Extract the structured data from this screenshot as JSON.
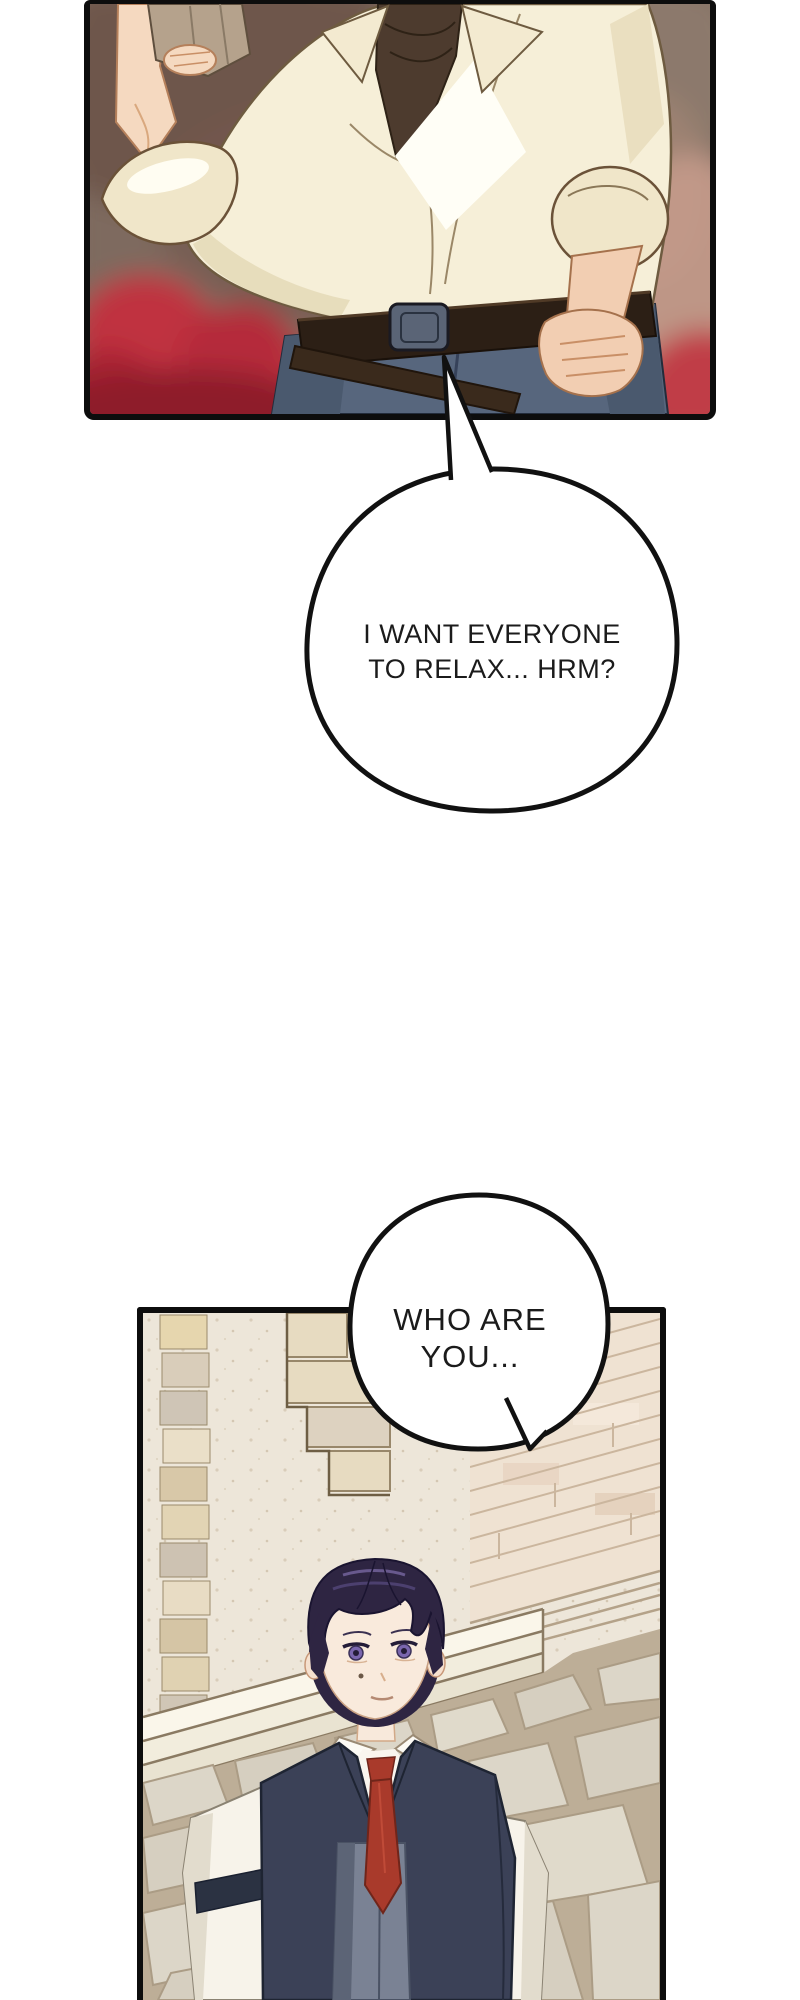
{
  "page": {
    "kind": "webtoon comic strip segment",
    "background_color": "#ffffff"
  },
  "speech_bubbles": [
    {
      "id": "bubble-1",
      "lines": [
        "I WANT EVERYONE",
        "TO RELAX... HRM?"
      ],
      "tail_direction": "up into panel 1",
      "fill": "#ffffff",
      "outline": "#111111",
      "text_color": "#1b1b1b"
    },
    {
      "id": "bubble-2",
      "lines": [
        "WHO ARE",
        "YOU..."
      ],
      "tail_direction": "down-right over panel 2",
      "fill": "#ffffff",
      "outline": "#111111",
      "text_color": "#1b1b1b"
    }
  ],
  "panels": [
    {
      "id": "panel-1",
      "description": "Torso of a man in a loose cream shirt over a dark brown turtleneck; right hand raised holding a tan cloth, left hand on hip; dark belt with diagonal strap and slate-blue trousers; blurred red and brown hall background",
      "colors": {
        "border": "#0d0d0d",
        "background_brown": "#7E6A5F",
        "chair_red": "#C0313F",
        "shirt_cream": "#F6EFD8",
        "turtleneck_brown": "#4D3B2E",
        "belt_brown": "#2C1F15",
        "buckle_slate": "#5A6476",
        "pants_slate": "#57667D",
        "skin": "#F5D9C0",
        "cloth_tan": "#B5A28C"
      }
    },
    {
      "id": "panel-2",
      "description": "Young man with dark purple hair and violet eyes, wearing a white shirt, red tie and navy vest, standing in a cream stone courtyard with brick walls, a white plinth and flagstone pavement",
      "colors": {
        "border": "#0d0d0d",
        "plaster": "#EDE6D9",
        "brick_tan": "#E6D6AE",
        "brick_wall_pink": "#EFE2D2",
        "plinth_white": "#FAF6EA",
        "pavement_mortar": "#BDAE97",
        "flagstone": "#DCD6C8",
        "hair_purple": "#2E2542",
        "hair_highlight": "#6F5F96",
        "skin": "#F9EADC",
        "eye_violet": "#7A66AE",
        "shirt_white": "#F7F3EA",
        "vest_navy": "#3B4157",
        "vest_panel_gray": "#7A8294",
        "armband_navy": "#2B3242",
        "tie_red": "#A93A2B"
      }
    }
  ]
}
